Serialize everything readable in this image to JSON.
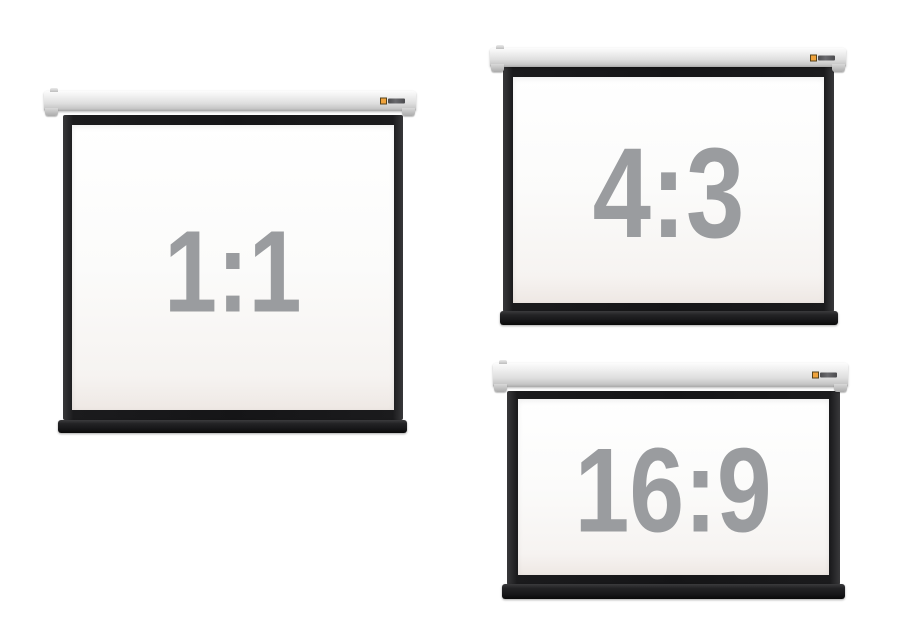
{
  "screens": [
    {
      "name": "projection-screen-1-1",
      "ratio_label": "1:1"
    },
    {
      "name": "projection-screen-4-3",
      "ratio_label": "4:3"
    },
    {
      "name": "projection-screen-16-9",
      "ratio_label": "16:9"
    }
  ],
  "colors": {
    "background": "#ffffff",
    "casing_gray": "#dedede",
    "frame_black": "#1b1b1d",
    "screen_white": "#fbfbfa",
    "ratio_text_gray": "#9a9c9f",
    "logo_accent_orange": "#f0a33c"
  },
  "icons": {
    "brand_logo": "brand-logo-icon"
  }
}
